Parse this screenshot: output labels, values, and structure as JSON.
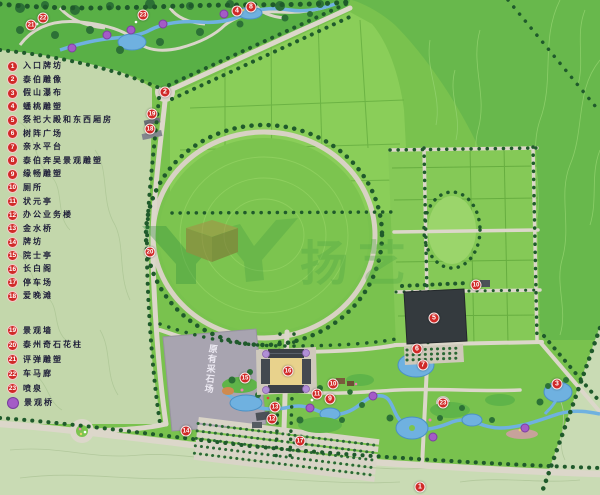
{
  "map": {
    "watermark": {
      "logo": "YY",
      "text": "扬艺"
    },
    "quarry_label": "原有采石场",
    "colors": {
      "marker_red": "#d02a28",
      "bridge_purple": "#a45bc7",
      "water_blue": "#6fb1e0",
      "road_beige": "#dcd7ca",
      "tree_dark_green": "#1f5a2b",
      "field_green": "#79c24e",
      "pale_green": "#c9dbb4",
      "hall_dark": "#343a3e",
      "quarry_gray": "#a8a4b0",
      "courtyard_yellow": "#e8d28c",
      "watermark_green": "#53a844"
    }
  },
  "legend": {
    "items": [
      {
        "num": "1",
        "label": "入口牌坊"
      },
      {
        "num": "2",
        "label": "泰伯雕像"
      },
      {
        "num": "3",
        "label": "假山瀑布"
      },
      {
        "num": "4",
        "label": "蟠桃雕塑"
      },
      {
        "num": "5",
        "label": "祭祀大殿和东西厢房"
      },
      {
        "num": "6",
        "label": "树阵广场"
      },
      {
        "num": "7",
        "label": "亲水平台"
      },
      {
        "num": "8",
        "label": "泰伯奔吴景观雕塑"
      },
      {
        "num": "9",
        "label": "缘畅雕塑"
      },
      {
        "num": "10",
        "label": "厕所"
      },
      {
        "num": "11",
        "label": "状元亭"
      },
      {
        "num": "12",
        "label": "办公业务楼"
      },
      {
        "num": "13",
        "label": "金水桥"
      },
      {
        "num": "14",
        "label": "牌坊"
      },
      {
        "num": "15",
        "label": "院士亭"
      },
      {
        "num": "16",
        "label": "长白阁"
      },
      {
        "num": "17",
        "label": "停车场"
      },
      {
        "num": "18",
        "label": "爱晚滩"
      },
      {
        "num": "19",
        "label": "景观墙"
      },
      {
        "num": "20",
        "label": "泰州奇石花柱"
      },
      {
        "num": "21",
        "label": "评弹雕塑"
      },
      {
        "num": "22",
        "label": "车马廊"
      },
      {
        "num": "23",
        "label": "喷泉"
      }
    ],
    "bridge": {
      "label": "景观桥"
    }
  },
  "markers": [
    {
      "num": "21",
      "x": 31,
      "y": 25
    },
    {
      "num": "22",
      "x": 43,
      "y": 18
    },
    {
      "num": "23",
      "x": 143,
      "y": 15
    },
    {
      "num": "4",
      "x": 237,
      "y": 11
    },
    {
      "num": "8",
      "x": 251,
      "y": 7
    },
    {
      "num": "2",
      "x": 165,
      "y": 92
    },
    {
      "num": "19",
      "x": 152,
      "y": 114
    },
    {
      "num": "18",
      "x": 150,
      "y": 129
    },
    {
      "num": "20",
      "x": 150,
      "y": 252
    },
    {
      "num": "10",
      "x": 476,
      "y": 285
    },
    {
      "num": "5",
      "x": 434,
      "y": 318
    },
    {
      "num": "6",
      "x": 417,
      "y": 349
    },
    {
      "num": "7",
      "x": 423,
      "y": 365
    },
    {
      "num": "16",
      "x": 288,
      "y": 371
    },
    {
      "num": "15",
      "x": 245,
      "y": 378
    },
    {
      "num": "10",
      "x": 333,
      "y": 384
    },
    {
      "num": "11",
      "x": 317,
      "y": 394
    },
    {
      "num": "9",
      "x": 330,
      "y": 399
    },
    {
      "num": "13",
      "x": 275,
      "y": 407
    },
    {
      "num": "12",
      "x": 272,
      "y": 419
    },
    {
      "num": "14",
      "x": 186,
      "y": 431
    },
    {
      "num": "17",
      "x": 300,
      "y": 441
    },
    {
      "num": "23",
      "x": 443,
      "y": 403
    },
    {
      "num": "3",
      "x": 557,
      "y": 384
    },
    {
      "num": "1",
      "x": 420,
      "y": 487
    }
  ],
  "bridges": [
    [
      72,
      48
    ],
    [
      107,
      35
    ],
    [
      131,
      30
    ],
    [
      163,
      24
    ],
    [
      224,
      14
    ],
    [
      310,
      408
    ],
    [
      373,
      396
    ],
    [
      433,
      437
    ],
    [
      525,
      428
    ]
  ]
}
